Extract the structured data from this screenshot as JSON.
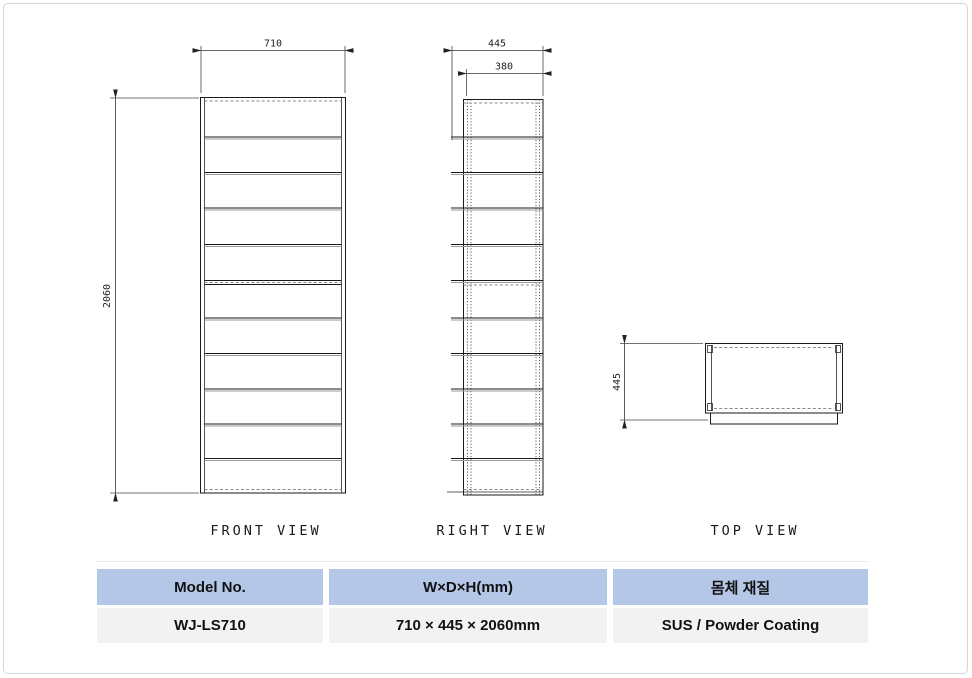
{
  "drawing": {
    "front": {
      "title": "FRONT VIEW",
      "dim_width": "710",
      "dim_height": "2060"
    },
    "right": {
      "title": "RIGHT VIEW",
      "dim_depth_outer": "445",
      "dim_depth_inner": "380"
    },
    "top": {
      "title": "TOP VIEW",
      "dim_depth": "445"
    }
  },
  "spec_table": {
    "headers": [
      {
        "label": "Model No."
      },
      {
        "label": "W×D×H(mm)"
      },
      {
        "label": "몸체 재질"
      }
    ],
    "row": [
      {
        "value": "WJ-LS710"
      },
      {
        "value": "710 × 445 × 2060mm"
      },
      {
        "value": "SUS / Powder Coating"
      }
    ],
    "colors": {
      "header_bg": "#b4c7e7",
      "row_bg": "#f2f2f2",
      "line": "#1a1a1a"
    }
  }
}
